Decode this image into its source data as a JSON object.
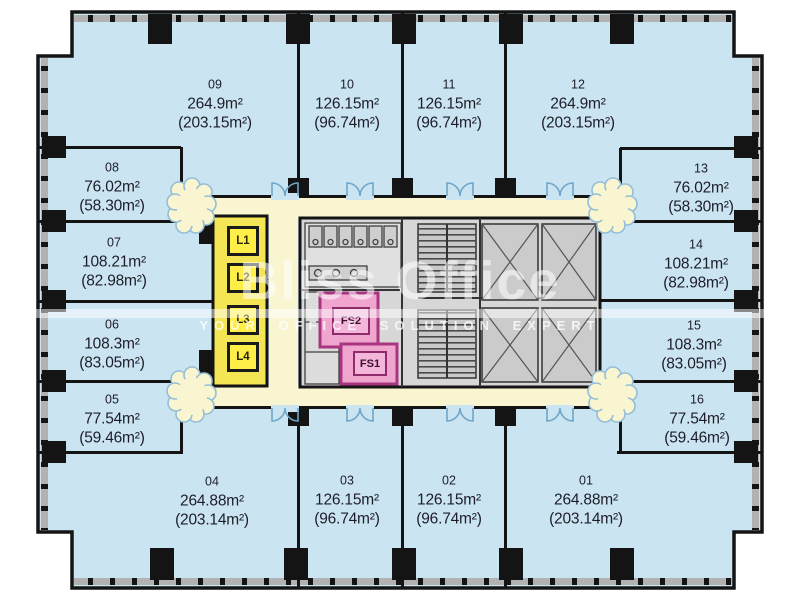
{
  "watermark": {
    "brand": "Bliss Office",
    "tagline": "YOUR OFFICE SOLUTION EXPERT"
  },
  "units": [
    {
      "id": "01",
      "area": "264.88m²",
      "area_paren": "(203.14m²)"
    },
    {
      "id": "02",
      "area": "126.15m²",
      "area_paren": "(96.74m²)"
    },
    {
      "id": "03",
      "area": "126.15m²",
      "area_paren": "(96.74m²)"
    },
    {
      "id": "04",
      "area": "264.88m²",
      "area_paren": "(203.14m²)"
    },
    {
      "id": "05",
      "area": "77.54m²",
      "area_paren": "(59.46m²)"
    },
    {
      "id": "06",
      "area": "108.3m²",
      "area_paren": "(83.05m²)"
    },
    {
      "id": "07",
      "area": "108.21m²",
      "area_paren": "(82.98m²)"
    },
    {
      "id": "08",
      "area": "76.02m²",
      "area_paren": "(58.30m²)"
    },
    {
      "id": "09",
      "area": "264.9m²",
      "area_paren": "(203.15m²)"
    },
    {
      "id": "10",
      "area": "126.15m²",
      "area_paren": "(96.74m²)"
    },
    {
      "id": "11",
      "area": "126.15m²",
      "area_paren": "(96.74m²)"
    },
    {
      "id": "12",
      "area": "264.9m²",
      "area_paren": "(203.15m²)"
    },
    {
      "id": "13",
      "area": "76.02m²",
      "area_paren": "(58.30m²)"
    },
    {
      "id": "14",
      "area": "108.21m²",
      "area_paren": "(82.98m²)"
    },
    {
      "id": "15",
      "area": "108.3m²",
      "area_paren": "(83.05m²)"
    },
    {
      "id": "16",
      "area": "77.54m²",
      "area_paren": "(59.46m²)"
    }
  ],
  "core": {
    "lifts": [
      "L1",
      "L2",
      "L3",
      "L4"
    ],
    "fire_stairs": [
      "FS2",
      "FS1"
    ]
  },
  "colors": {
    "unit_fill": "#cbe4f2",
    "corridor_fill": "#f9f5d0",
    "core_fill": "#d7d7d7",
    "lift_yellow": "#ffee48",
    "lift_block_yellow": "#f4e554",
    "fire_pink": "#f0a5cf",
    "fire_pink_border": "#a8357f",
    "wall": "#141414",
    "door_arc_blue": "#6fa6c8",
    "watermark_white": "#ffffff"
  }
}
